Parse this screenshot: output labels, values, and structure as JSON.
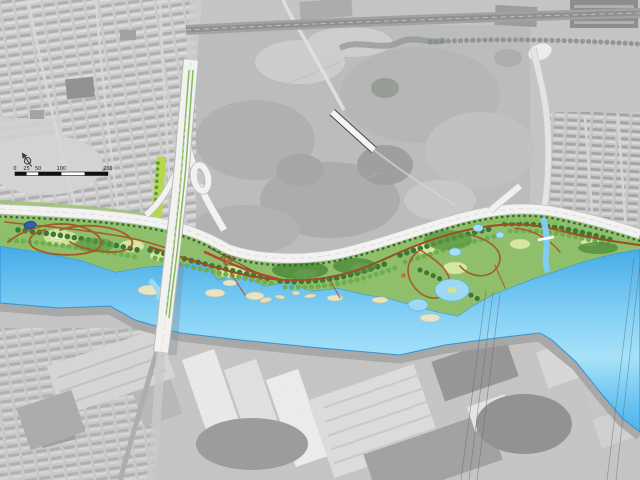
{
  "map": {
    "scale_bar": {
      "labels": [
        "0",
        "25",
        "50",
        "100",
        "200"
      ]
    }
  },
  "palette": {
    "aerial_gray": "#c6c6c6",
    "river_blue": "#6cc9f4",
    "park_green": "#8fbf6a",
    "tree_dark_green": "#3c7733",
    "lawn_light": "#d6e7a2",
    "path_brown": "#a35c2a",
    "road_white": "#f2f2f0",
    "accent_lime": "#b5d94e",
    "pond_blue": "#2f62aa"
  },
  "icons": {
    "north_arrow": "north-arrow-icon"
  }
}
